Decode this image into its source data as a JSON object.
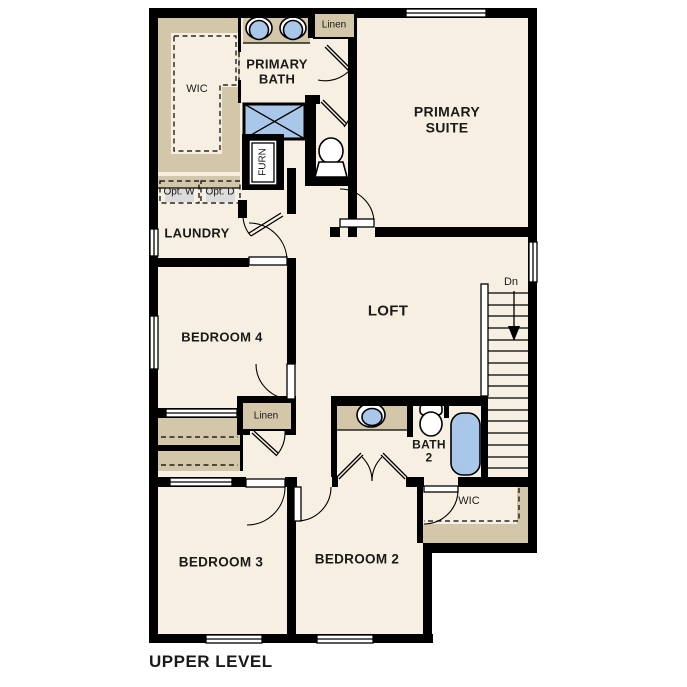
{
  "plan": {
    "title": "UPPER LEVEL",
    "rooms": {
      "wic_primary": "WIC",
      "primary_bath": "PRIMARY BATH",
      "linen_upper": "Linen",
      "primary_suite": "PRIMARY SUITE",
      "opt_washer": "Opt. W",
      "opt_dryer": "Opt. D",
      "laundry": "LAUNDRY",
      "furnace": "FURN",
      "bedroom4": "BEDROOM 4",
      "loft": "LOFT",
      "stairs_direction": "Dn",
      "linen_lower": "Linen",
      "bath2": "BATH 2",
      "wic_secondary": "WIC",
      "bedroom3": "BEDROOM 3",
      "bedroom2": "BEDROOM 2"
    },
    "colors": {
      "wall": "#000000",
      "floor": "#f7efe2",
      "shelving_tan": "#d3c6a9",
      "fixture_blue": "#a9c8e9",
      "appliance_gray": "#dcdcdc",
      "background": "#ffffff",
      "text": "#1a1a1a"
    }
  }
}
